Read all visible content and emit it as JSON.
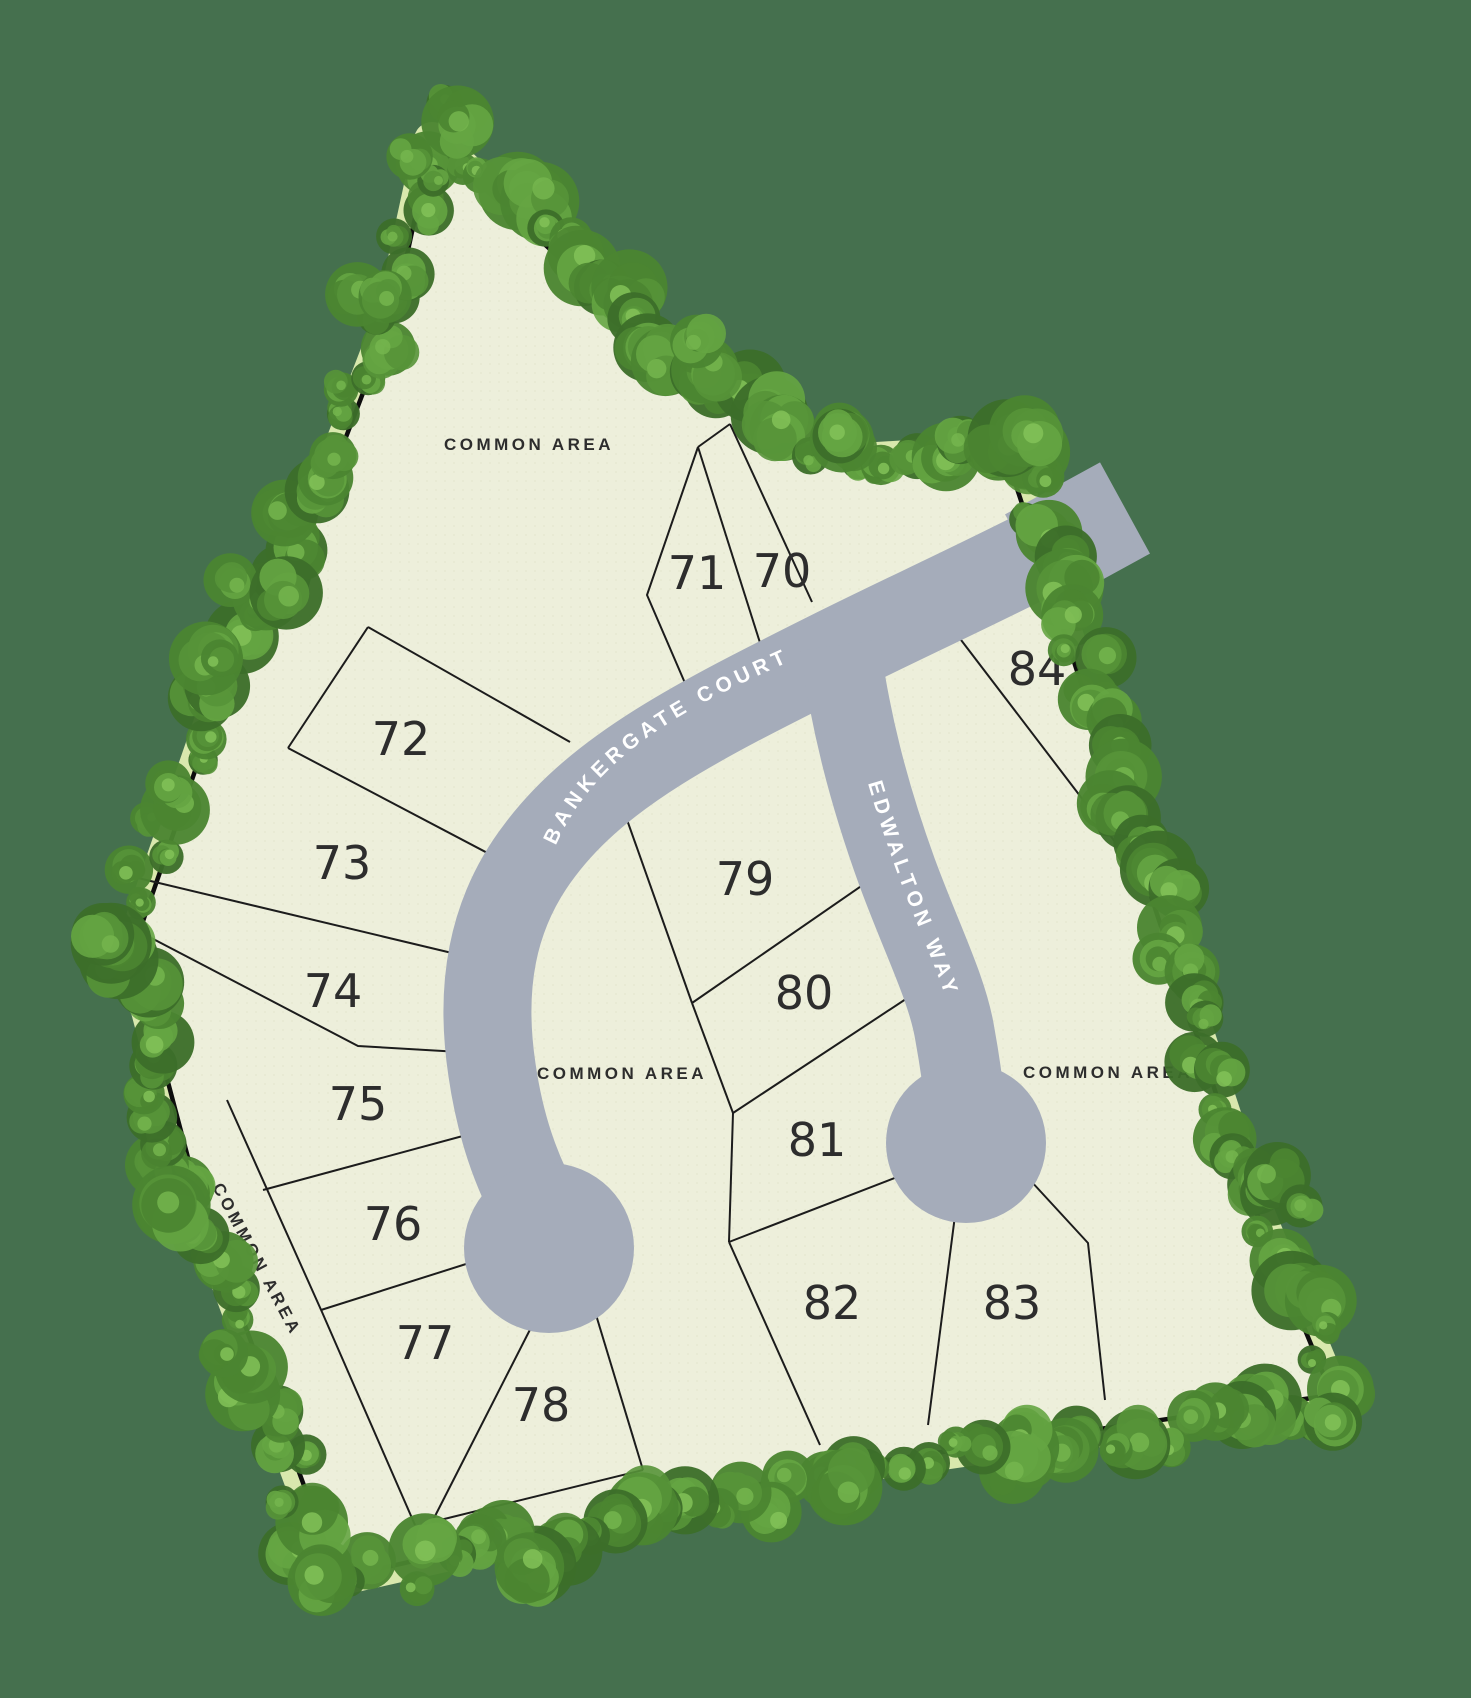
{
  "map": {
    "type": "residential-subdivision-site-plan",
    "streets": [
      {
        "name": "BANKERGATE COURT"
      },
      {
        "name": "EDWALTON WAY"
      }
    ],
    "labels": {
      "common_area": "COMMON AREA"
    },
    "lots": [
      "70",
      "71",
      "72",
      "73",
      "74",
      "75",
      "76",
      "77",
      "78",
      "79",
      "80",
      "81",
      "82",
      "83",
      "84"
    ],
    "colors": {
      "background": "#45704e",
      "site_fill": "#edefdb",
      "buffer": "#d9e8ad",
      "boundary_line": "#0d0d0d",
      "lot_line": "#1c1c1c",
      "road": "#a5acba",
      "street_text": "#ffffff",
      "label_text": "#2d2d2d",
      "tree_palette": [
        "#2f5a21",
        "#3c6e2a",
        "#4b8531",
        "#579338",
        "#65a542",
        "#74b54d",
        "#83c258"
      ]
    }
  }
}
